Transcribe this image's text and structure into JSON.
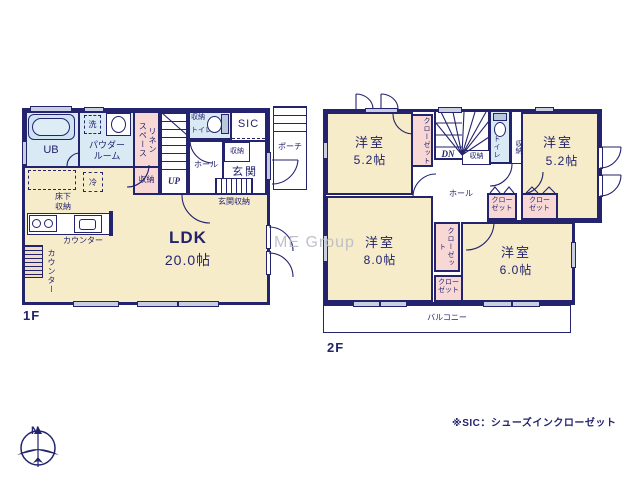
{
  "watermark": "ME Group",
  "footnote": "※SIC：シューズインクローゼット",
  "compass": {
    "north_label": "N"
  },
  "floor1": {
    "name": "1F",
    "labels": {
      "ub": "UB",
      "washer": "洗",
      "powder_room": "パウダー\nルーム",
      "linen_space": "リネン\nスペース",
      "stairs": "UP",
      "toilet_storage": "収納",
      "toilet": "トイレ",
      "sic": "SIC",
      "porch": "ポーチ",
      "entrance": "玄関",
      "entrance_closet": "収納",
      "hall": "ホール",
      "stair_storage": "収納",
      "underfloor_storage": "床下\n収納",
      "refrigerator": "冷",
      "kitchen_counter": "カウンター",
      "side_counter": "カウンター",
      "ldk": "LDK",
      "ldk_size": "20.0帖",
      "entrance_storage": "玄関収納"
    }
  },
  "floor2": {
    "name": "2F",
    "labels": {
      "nw_room": "洋室",
      "nw_room_size": "5.2帖",
      "nw_closet": "クローゼット",
      "stairs": "DN",
      "stair_storage": "収納",
      "toilet": "トイレ",
      "toilet_storage": "収納",
      "ne_room": "洋室",
      "ne_room_size": "5.2帖",
      "hall": "ホール",
      "hall_closet": "クロー\nゼット",
      "ne_closet": "クロー\nゼット",
      "center_closet": "クローゼット",
      "sw_closet": "クロー\nゼット",
      "sw_room": "洋室",
      "sw_room_size": "8.0帖",
      "se_room": "洋室",
      "se_room_size": "6.0帖",
      "balcony": "バルコニー"
    }
  }
}
